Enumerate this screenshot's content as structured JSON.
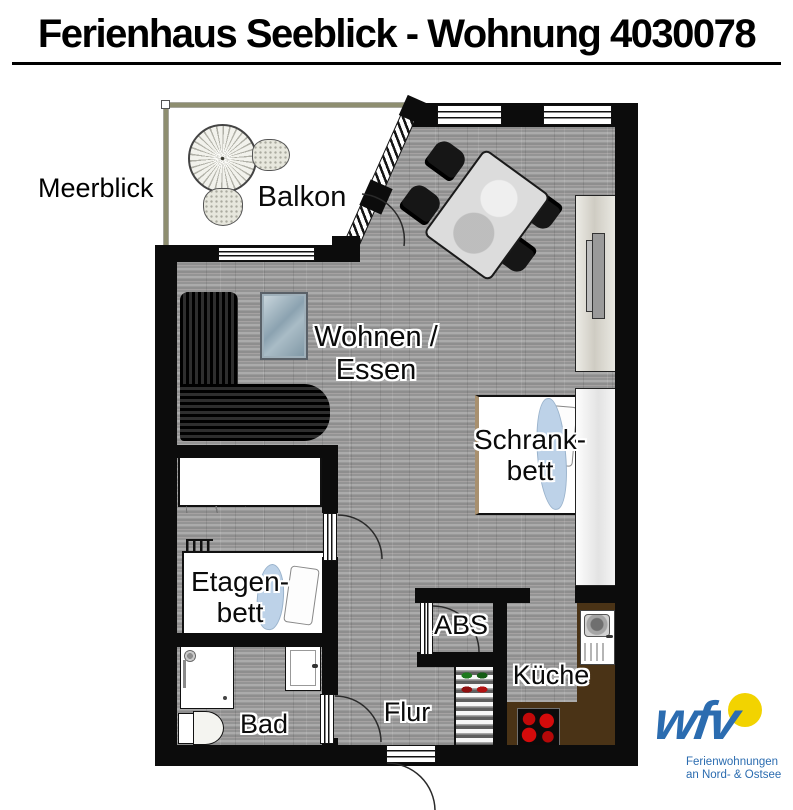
{
  "title": "Ferienhaus Seeblick - Wohnung 4030078",
  "outside_label": "Meerblick",
  "labels": {
    "balkon": "Balkon",
    "wohnen": [
      "Wohnen /",
      "Essen"
    ],
    "schrankbett": [
      "Schrank-",
      "bett"
    ],
    "etagenbett": [
      "Etagen-",
      "bett"
    ],
    "abs": "ABS",
    "kueche": "Küche",
    "bad": "Bad",
    "flur": "Flur"
  },
  "logo": {
    "brand": "wfv",
    "tagline": [
      "Ferienwohnungen",
      "an Nord- & Ostsee"
    ],
    "brand_color": "#2b6cb0",
    "sun_color": "#f2d300"
  },
  "colors": {
    "wall": "#0c0c0c",
    "floor": "#9c9c9c",
    "balcony_floor": "#ffffff",
    "kitchen_counter": "#4a3316",
    "blanket_blue": "#bdd2e8",
    "stove_burner_red": "#cc0a0a",
    "railing_olive": "#8e8e70",
    "tv_screen": "#8ba2b0"
  },
  "symbols": [
    "balcony-table",
    "balcony-chair",
    "dining-table",
    "dining-chair",
    "corner-sofa",
    "tv",
    "sideboard",
    "tall-cabinet",
    "wall-bed",
    "bunk-bed",
    "ladder",
    "wardrobe",
    "shower",
    "toilet",
    "washbasin",
    "shoe-rack",
    "kitchen-sink",
    "stove",
    "kitchen-counter",
    "door-swing-arc",
    "window",
    "railing"
  ]
}
